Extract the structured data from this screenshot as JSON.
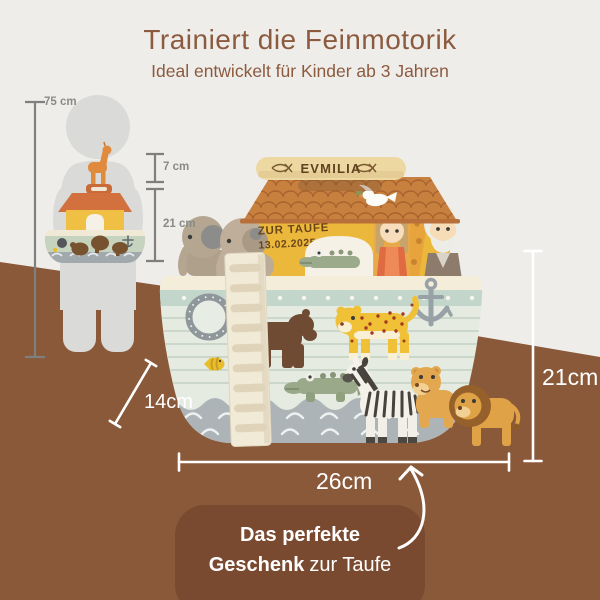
{
  "header": {
    "title": "Trainiert die Feinmotorik",
    "subtitle": "Ideal entwickelt für Kinder ab 3 Jahren"
  },
  "size_reference": {
    "child_height": "75 cm",
    "giraffe_height": "7 cm",
    "ark_height": "21 cm"
  },
  "product": {
    "name_plate": "EVMILIA",
    "engraving_line1": "ZUR TAUFE",
    "engraving_line2": "13.02.2025"
  },
  "measurements": {
    "depth": "14cm",
    "height": "21cm",
    "width": "26cm"
  },
  "callout": {
    "line1": "Das perfekte",
    "line2_bold": "Geschenk",
    "line2_rest": "zur Taufe"
  },
  "icons": {
    "name_plate_symbol": "ichthys-fish",
    "hull_symbols": "porthole, anchor, fish, waves",
    "roof_symbol": "dove-with-olive-branch"
  },
  "colors": {
    "title_brown": "#8C5B3F",
    "background_top": "#EFEDEA",
    "background_bottom": "#8A5939",
    "callout_pill": "#7A4A30",
    "annotation_white": "#FFFFFF",
    "ruler_gray": "#7F7F7F",
    "silhouette_gray": "#DADAD8"
  }
}
